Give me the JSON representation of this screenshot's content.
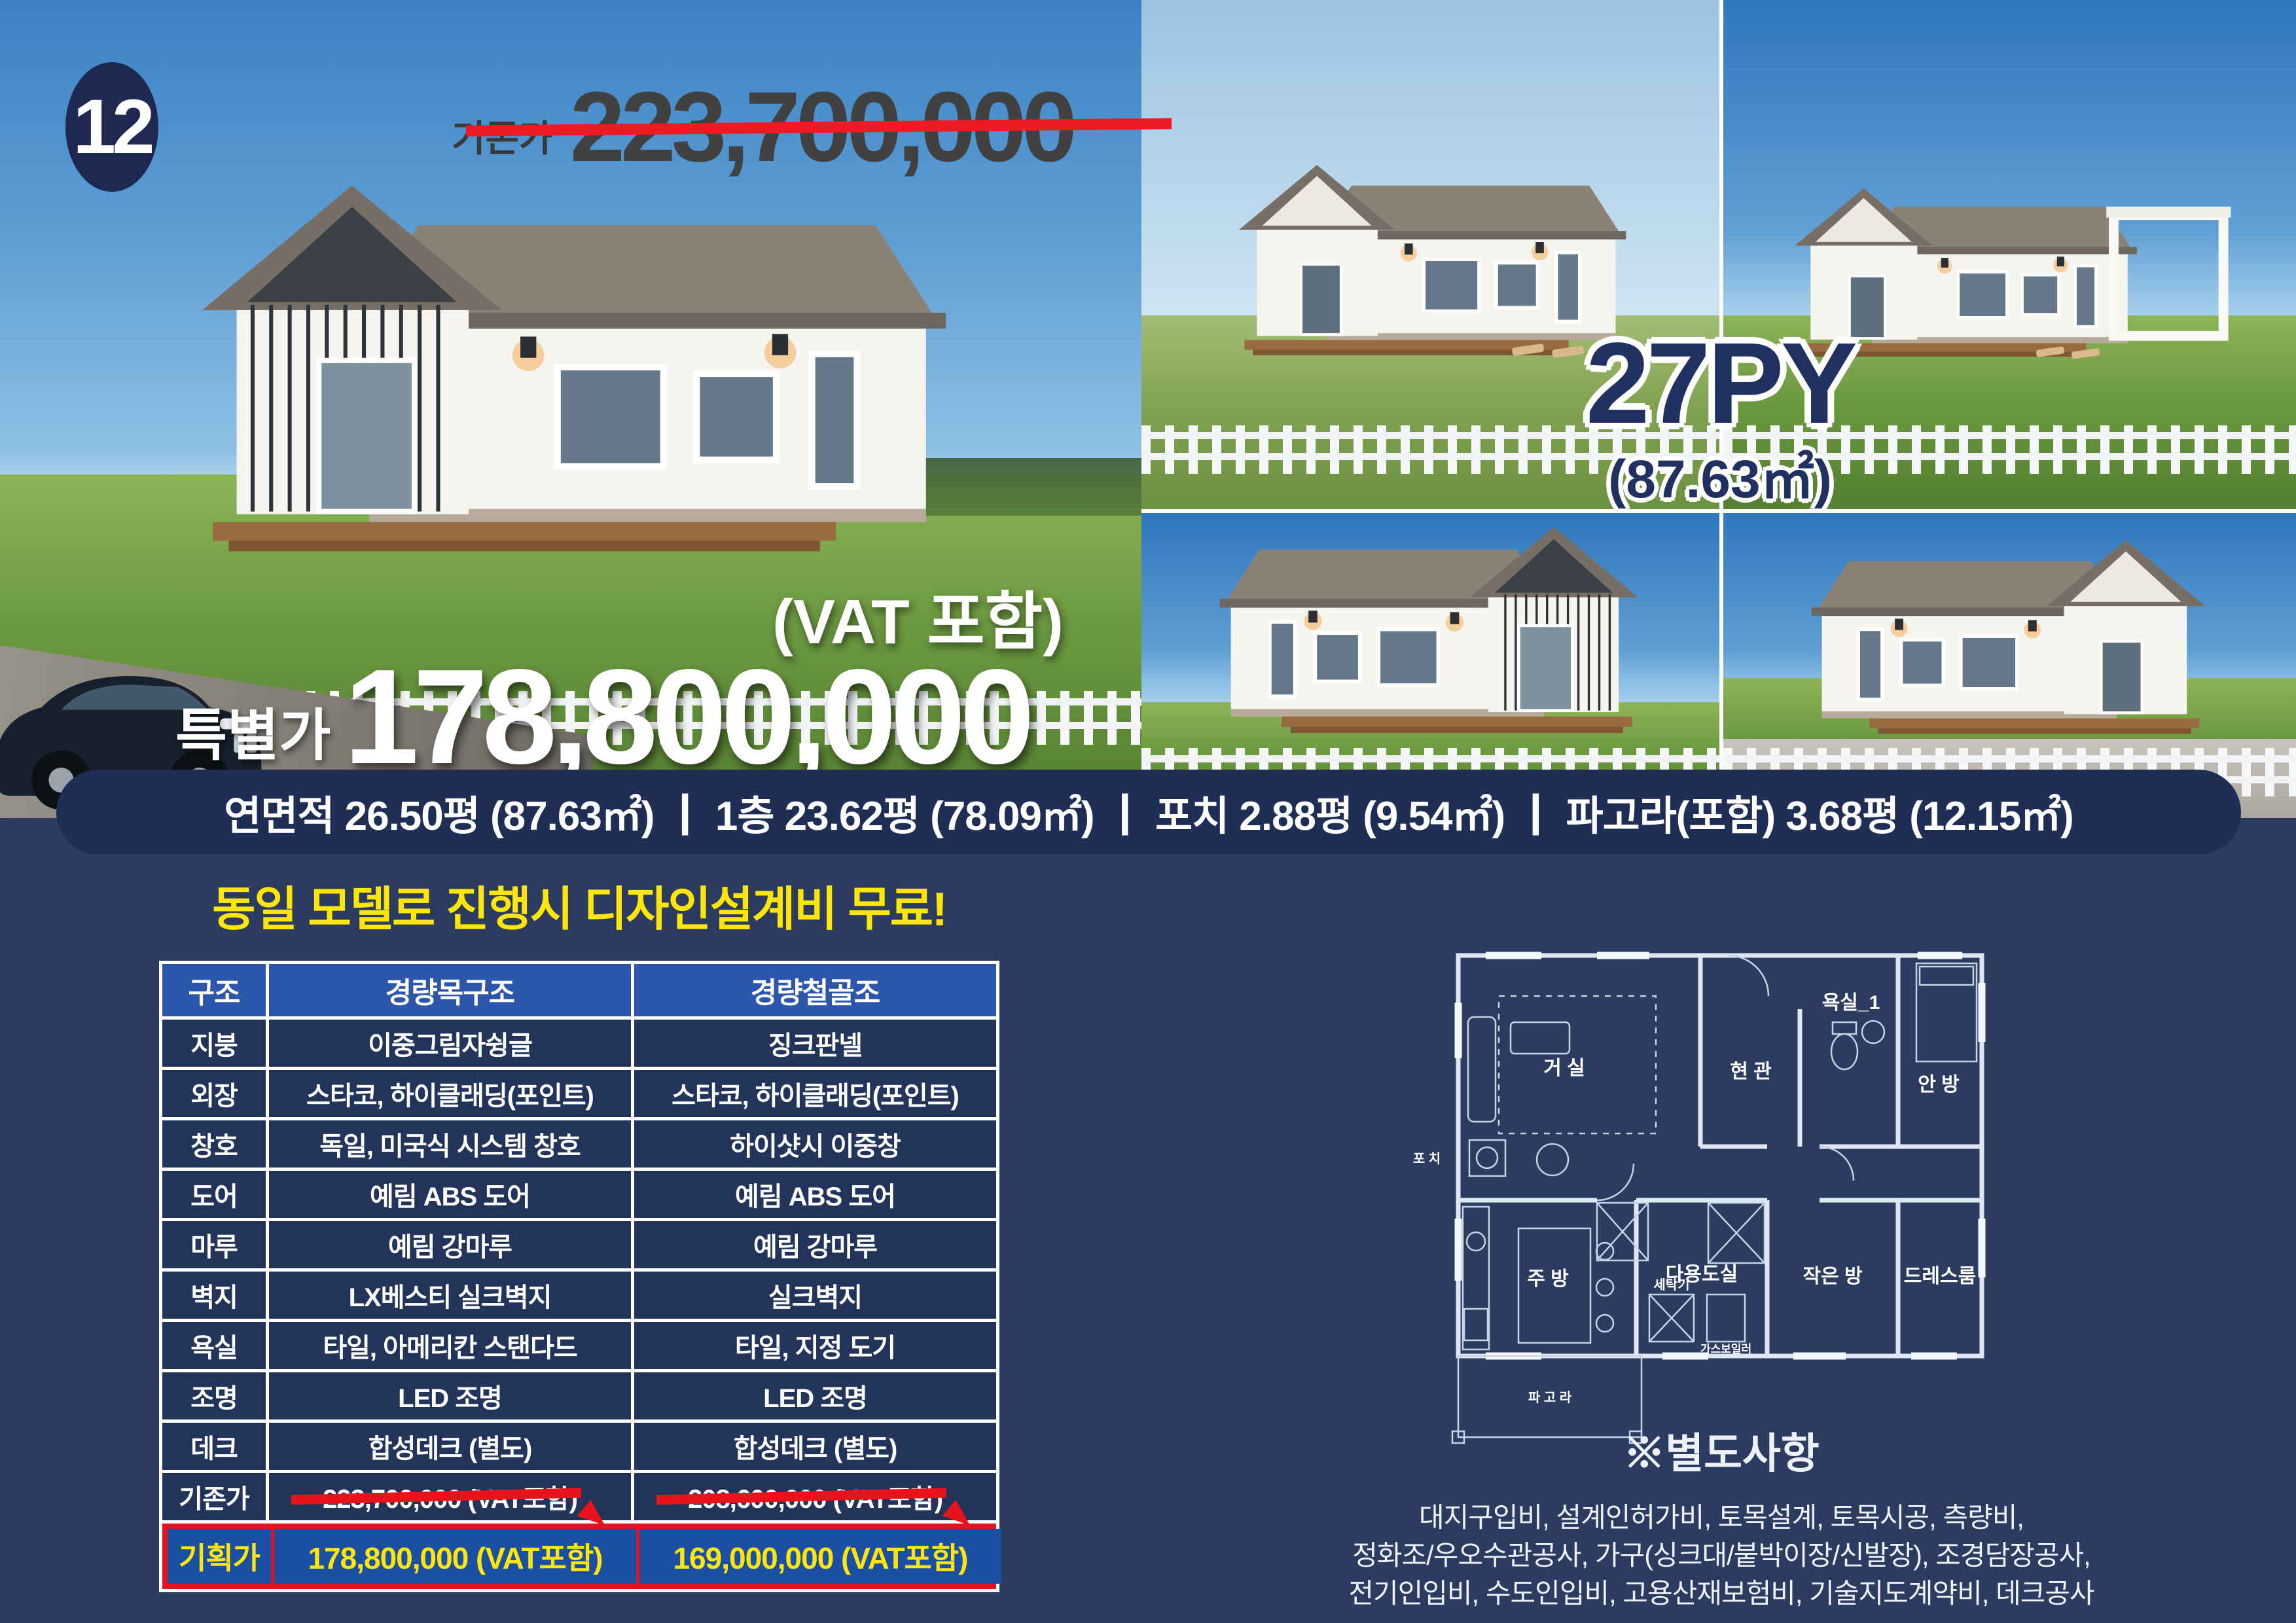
{
  "badge": {
    "number": "12"
  },
  "hero": {
    "old_price_label": "기존가",
    "old_price": "223,700,000",
    "vat_note": "(VAT 포함)",
    "special_label": "특별가",
    "special_price": "178,800,000",
    "size_title": "27PY",
    "size_sub": "(87.63㎡)"
  },
  "banner": {
    "text": "연면적 26.50평 (87.63㎡) ┃ 1층 23.62평 (78.09㎡) ┃ 포치 2.88평 (9.54㎡) ┃ 파고라(포함) 3.68평 (12.15㎡)"
  },
  "promo": {
    "headline": "동일 모델로 진행시 디자인설계비 무료!"
  },
  "table": {
    "header": [
      "구조",
      "경량목구조",
      "경량철골조"
    ],
    "rows": [
      [
        "지붕",
        "이중그림자슁글",
        "징크판넬"
      ],
      [
        "외장",
        "스타코, 하이클래딩(포인트)",
        "스타코, 하이클래딩(포인트)"
      ],
      [
        "창호",
        "독일, 미국식 시스템 창호",
        "하이샷시 이중창"
      ],
      [
        "도어",
        "예림 ABS 도어",
        "예림 ABS 도어"
      ],
      [
        "마루",
        "예림 강마루",
        "예림 강마루"
      ],
      [
        "벽지",
        "LX베스티 실크벽지",
        "실크벽지"
      ],
      [
        "욕실",
        "타일, 아메리칸 스탠다드",
        "타일, 지정 도기"
      ],
      [
        "조명",
        "LED 조명",
        "LED 조명"
      ],
      [
        "데크",
        "합성데크 (별도)",
        "합성데크 (별도)"
      ]
    ],
    "old_row": [
      "기존가",
      "223,700,000 (VAT포함)",
      "208,600,000 (VAT포함)"
    ],
    "plan_row": [
      "기획가",
      "178,800,000 (VAT포함)",
      "169,000,000 (VAT포함)"
    ]
  },
  "floorplan": {
    "living": "거 실",
    "entrance": "현 관",
    "bath": "욕실_1",
    "master": "안 방",
    "porch": "포 치",
    "kitchen": "주 방",
    "utility": "다용도실",
    "washer": "세탁기",
    "boiler": "가스보일러",
    "small_room": "작은 방",
    "dress_room": "드레스룸",
    "pergola": "파 고 라"
  },
  "notes": {
    "heading": "※별도사항",
    "lines": [
      "대지구입비, 설계인허가비, 토목설계, 토목시공, 측량비,",
      "정화조/우오수관공사, 가구(싱크대/붙박이장/신발장), 조경담장공사,",
      "전기인입비, 수도인입비, 고용산재보험비, 기술지도계약비, 데크공사"
    ]
  },
  "colors": {
    "page_bg": "#2b3c60",
    "banner_bg": "#1f2e55",
    "table_header_blue": "#2b56a9",
    "plan_row_blue": "#1b4fa4",
    "accent_red": "#e8131b",
    "accent_yellow": "#ffe60a",
    "outline_navy": "#203060"
  }
}
